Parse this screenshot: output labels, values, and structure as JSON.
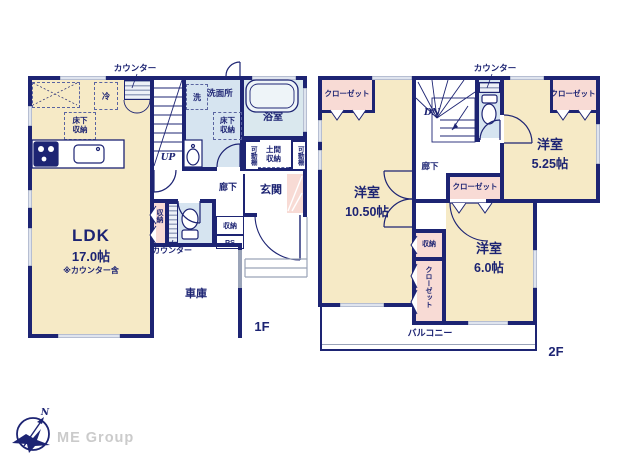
{
  "palette": {
    "wall": "#1d2473",
    "room_beige": "#f6eac6",
    "wet_blue": "#d6e4f0",
    "closet_pink": "#f8dbd5",
    "window": "#dfe4ee"
  },
  "floor1": {
    "floor_label": "1F",
    "ldk": {
      "name": "LDK",
      "size": "17.0帖",
      "note": "※カウンター含"
    },
    "garage": "車庫",
    "entrance": "玄関",
    "hall": "廊下",
    "bath": "浴室",
    "washroom": "洗面所",
    "washer": "洗",
    "fridge": "冷",
    "underfloor": "床下収納",
    "counter": "カウンター",
    "movable_shelf": "可動棚",
    "doma_storage": "土間収納",
    "storage": "収納",
    "ps": "PS",
    "up": "UP"
  },
  "floor2": {
    "floor_label": "2F",
    "rooms": {
      "a": {
        "name": "洋室",
        "size": "10.50帖"
      },
      "b": {
        "name": "洋室",
        "size": "5.25帖"
      },
      "c": {
        "name": "洋室",
        "size": "6.0帖"
      }
    },
    "balcony": "バルコニー",
    "hall": "廊下",
    "closet": "クローゼット",
    "storage": "収納",
    "counter": "カウンター",
    "dn": "DN"
  },
  "logo": {
    "company": "ME Group",
    "north": "N"
  }
}
